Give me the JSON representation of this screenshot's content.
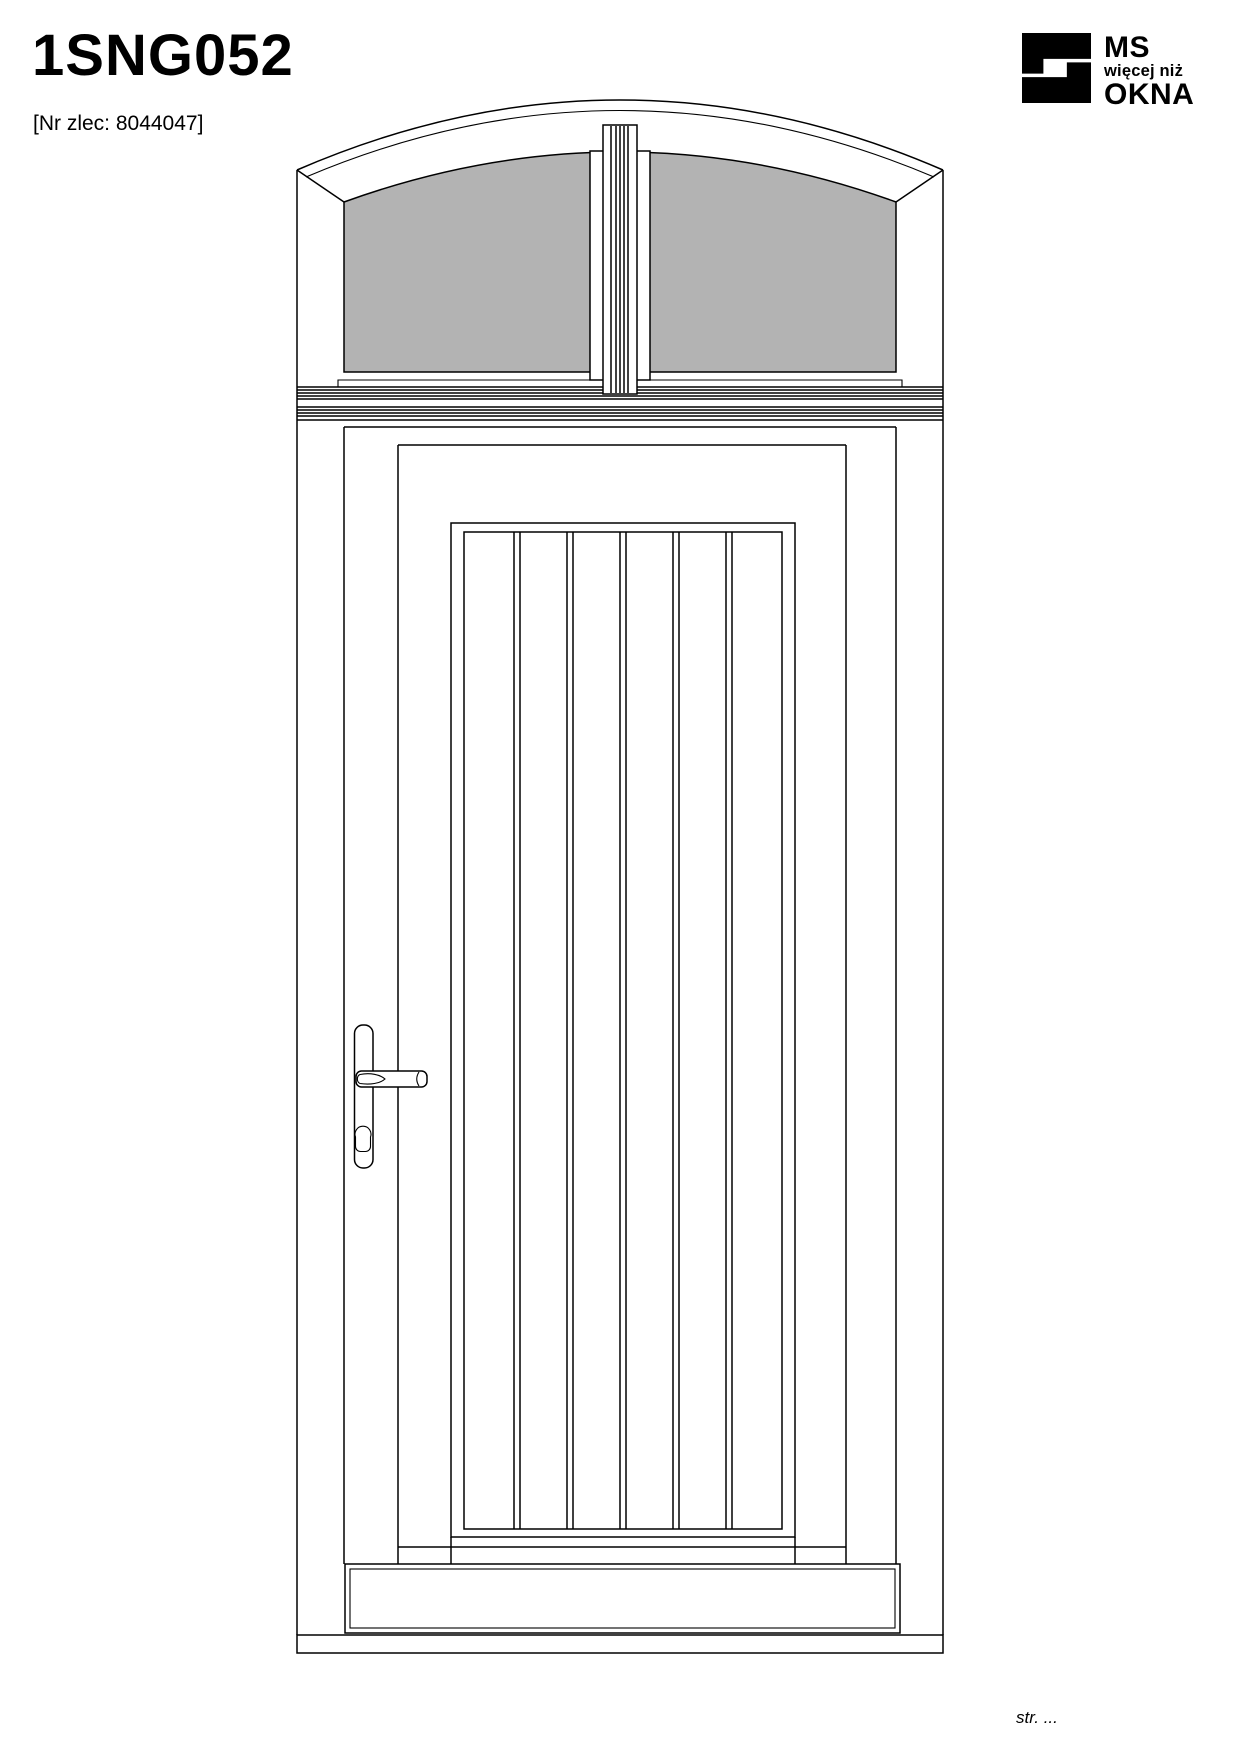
{
  "page": {
    "title": "1SNG052",
    "order_no": "[Nr zlec: 8044047]",
    "footer": "str. ..."
  },
  "logo": {
    "line1": "MS",
    "line2": "więcej niż",
    "line3": "OKNA",
    "icon": "ms-okna-monogram-icon",
    "color": "#000000"
  },
  "drawing": {
    "description": "Front elevation of a single-leaf entry door with arched glazed transom and central fluted mullion",
    "glass_color": "#b3b3b3",
    "line_color": "#000000",
    "background_color": "#ffffff",
    "components": [
      "arched-transom-frame",
      "transom-glass-left",
      "transom-glass-right",
      "central-fluted-mullion",
      "transom-bar-moldings",
      "door-frame",
      "door-leaf",
      "plank-panel-6-boards",
      "door-handle-with-backplate",
      "lock-cylinder",
      "weatherboard",
      "threshold"
    ]
  }
}
